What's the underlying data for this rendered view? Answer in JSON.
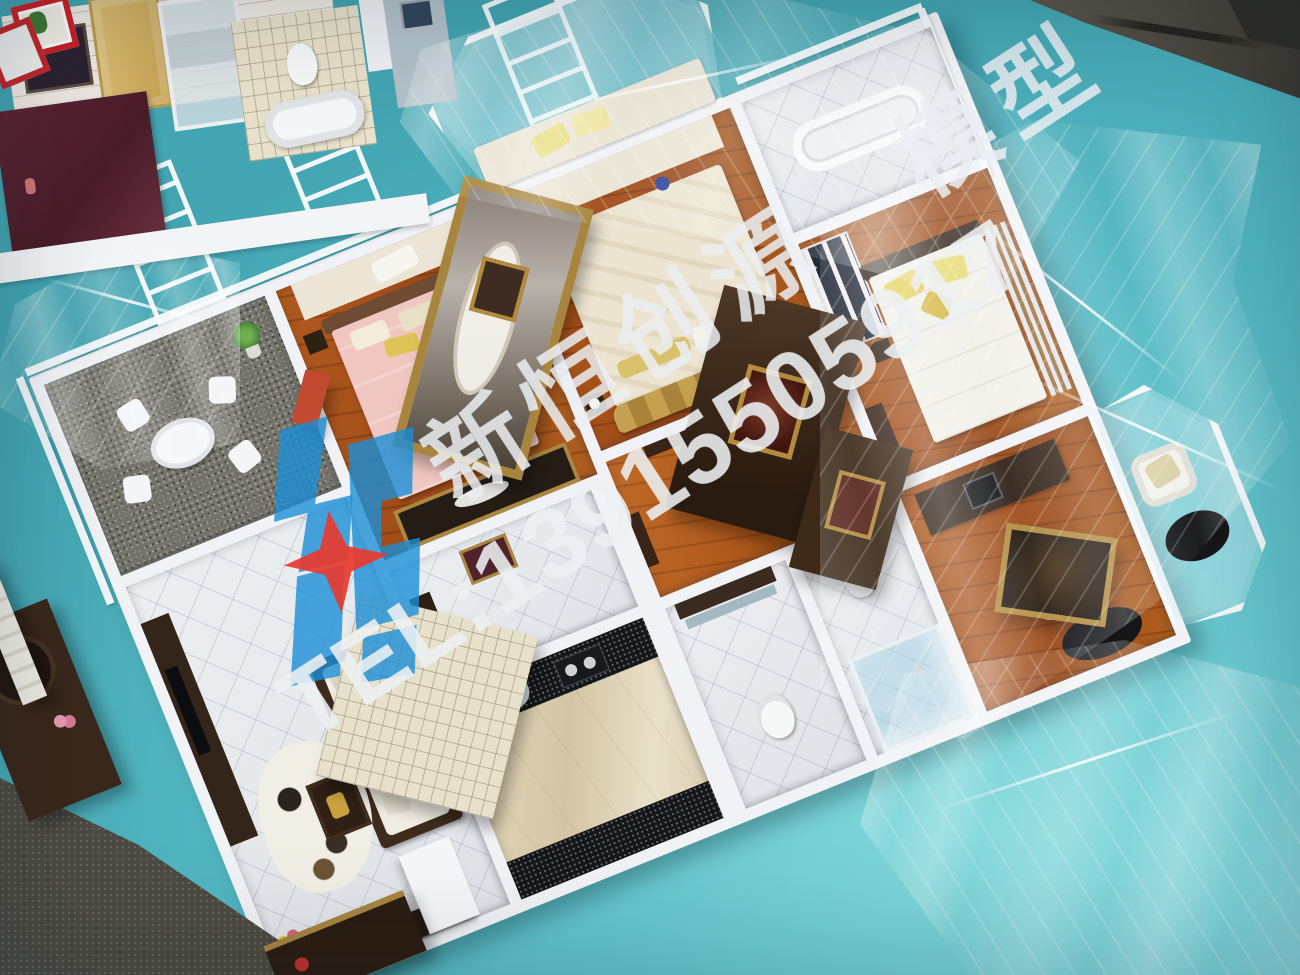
{
  "photo": {
    "subject": "miniature apartment interior sales model on a teal display table, partially covered with clear plastic wrap",
    "secondary_subject": "edge of a second interior model visible at top-left"
  },
  "watermark": {
    "company_text": "新恒创源　模型",
    "tel_text": "TEL:13915505917",
    "text_color": "#eaeef1",
    "logo_blue": "#1c8ed6",
    "logo_star_red": "#e8392e"
  },
  "palette": {
    "table_teal": "#5fc3cb",
    "model_wall_white": "#f1f2f5",
    "wood_floor_brown": "#a0521d",
    "white_tile_floor": "#e9ebee",
    "maroon_panel": "#552332",
    "granite_black": "#15161a",
    "gravel_gray": "#74736b",
    "gold_trim": "#ae8a41"
  },
  "rooms_visible": [
    "balcony",
    "living-room",
    "pink-bedroom",
    "master-bedroom",
    "right-bedroom",
    "kitchen",
    "bathroom",
    "shower-room",
    "study",
    "hallway",
    "secondary-model-bathroom"
  ]
}
